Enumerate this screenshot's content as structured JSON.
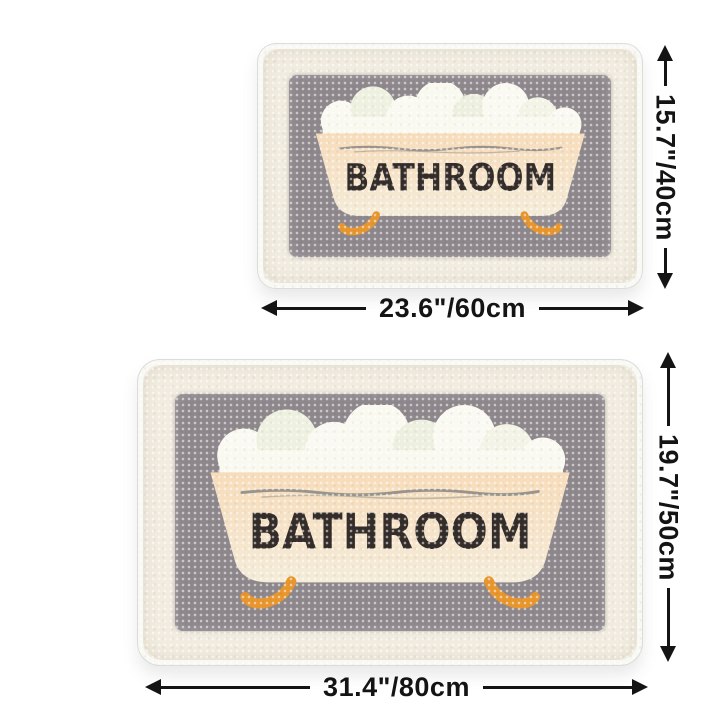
{
  "page": {
    "background": "#ffffff",
    "content_type": "product-size-diagram"
  },
  "colors": {
    "mat_border_cream": "#f1ecdf",
    "mat_backing_white": "#f8f8f5",
    "mat_panel_gray": "#8d878c",
    "tub_peach_top": "#f7dcba",
    "tub_cream_bottom": "#f4ecd9",
    "foam_white": "#fafaf2",
    "foam_tint_green": "#edf0df",
    "rim_line_gray": "#98948c",
    "mat_text_dark": "#332c28",
    "feet_orange": "#e8952c",
    "dimension_black": "#141414"
  },
  "mats": [
    {
      "name": "small-mat",
      "mat_text": "BATHROOM",
      "height_label": "15.7\"/40cm",
      "width_label": "23.6\"/60cm"
    },
    {
      "name": "large-mat",
      "mat_text": "BATHROOM",
      "height_label": "19.7\"/50cm",
      "width_label": "31.4\"/80cm"
    }
  ],
  "icons": {
    "vertical_measure": "double-headed-vertical-arrow",
    "horizontal_measure": "double-headed-horizontal-arrow",
    "illustration": "clawfoot-bathtub-with-foam"
  }
}
